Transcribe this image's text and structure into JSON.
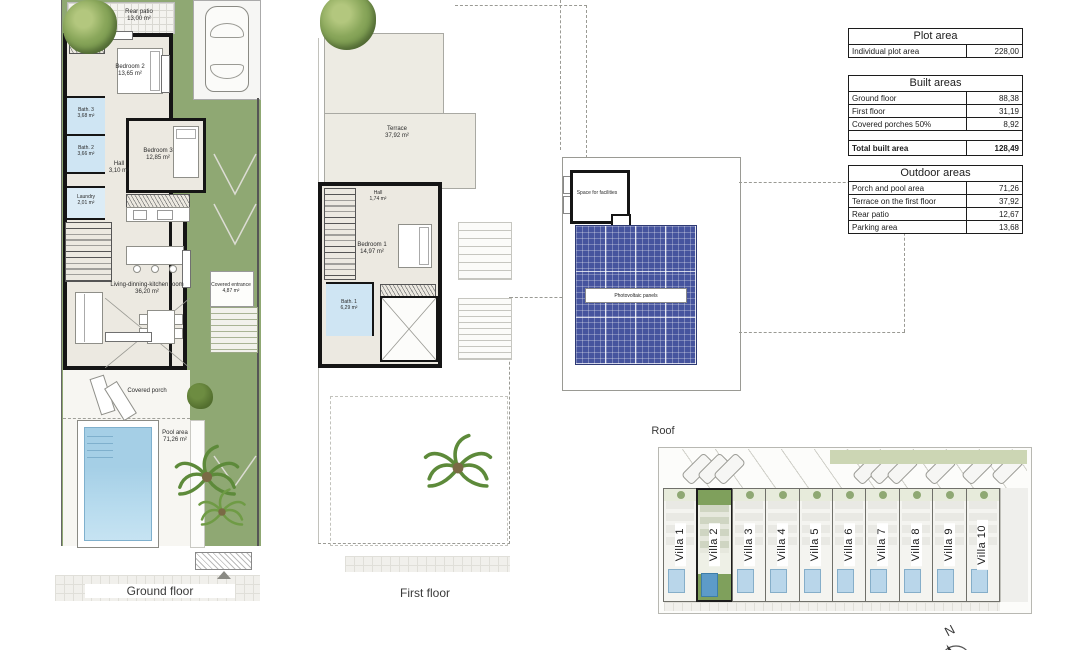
{
  "drawing": {
    "ground_floor": {
      "caption": "Ground floor",
      "rooms": {
        "rear_patio": {
          "name": "Rear patio",
          "area": "13,00 m²"
        },
        "bedroom2": {
          "name": "Bedroom 2",
          "area": "13,65 m²"
        },
        "bedroom3": {
          "name": "Bedroom 3",
          "area": "12,85 m²"
        },
        "bath3": {
          "name": "Bath. 3",
          "area": "3,68 m²"
        },
        "bath2": {
          "name": "Bath. 2",
          "area": "3,66 m²"
        },
        "hall": {
          "name": "Hall",
          "area": "3,10 m²"
        },
        "laundry": {
          "name": "Laundry",
          "area": "2,01 m²"
        },
        "living": {
          "name": "Living-dinning-kitchen room",
          "area": "36,20 m²"
        },
        "covered_entrance": {
          "name": "Covered entrance",
          "area": "4,87 m²"
        },
        "covered_porch": {
          "name": "Covered porch"
        },
        "pool": {
          "name": "Pool area",
          "area": "71,26 m²"
        }
      }
    },
    "first_floor": {
      "caption": "First floor",
      "rooms": {
        "terrace": {
          "name": "Terrace",
          "area": "37,92 m²"
        },
        "hall": {
          "name": "Hall",
          "area": "1,74 m²"
        },
        "bedroom1": {
          "name": "Bedroom 1",
          "area": "14,97 m²"
        },
        "bath1": {
          "name": "Bath. 1",
          "area": "6,29 m²"
        }
      }
    },
    "roof": {
      "caption": "Roof",
      "labels": {
        "facilities": "Space for facilities",
        "panels": "Photovoltaic panels"
      }
    },
    "site_plan": {
      "villas": [
        "Villa 1",
        "Villa 2",
        "Villa 3",
        "Villa 4",
        "Villa 5",
        "Villa 6",
        "Villa 7",
        "Villa 8",
        "Villa 9",
        "Villa 10"
      ],
      "highlighted_villa": "Villa 2",
      "compass": "N"
    }
  },
  "tables": {
    "plot": {
      "title": "Plot area",
      "rows": [
        {
          "label": "Individual plot area",
          "value": "228,00"
        }
      ]
    },
    "built": {
      "title": "Built areas",
      "rows": [
        {
          "label": "Ground floor",
          "value": "88,38"
        },
        {
          "label": "First floor",
          "value": "31,19"
        },
        {
          "label": "Covered porches 50%",
          "value": "8,92"
        }
      ],
      "total": {
        "label": "Total built area",
        "value": "128,49"
      }
    },
    "outdoor": {
      "title": "Outdoor areas",
      "rows": [
        {
          "label": "Porch and pool area",
          "value": "71,26"
        },
        {
          "label": "Terrace on the first floor",
          "value": "37,92"
        },
        {
          "label": "Rear patio",
          "value": "12,67"
        },
        {
          "label": "Parking area",
          "value": "13,68"
        }
      ]
    }
  },
  "colors": {
    "lawn": "#8fa873",
    "pool": "#aed4ea",
    "bath": "#cfe5f3",
    "solar_panel": "#46549e",
    "wall": "#151515",
    "highlight_green": "#7fa05c"
  }
}
